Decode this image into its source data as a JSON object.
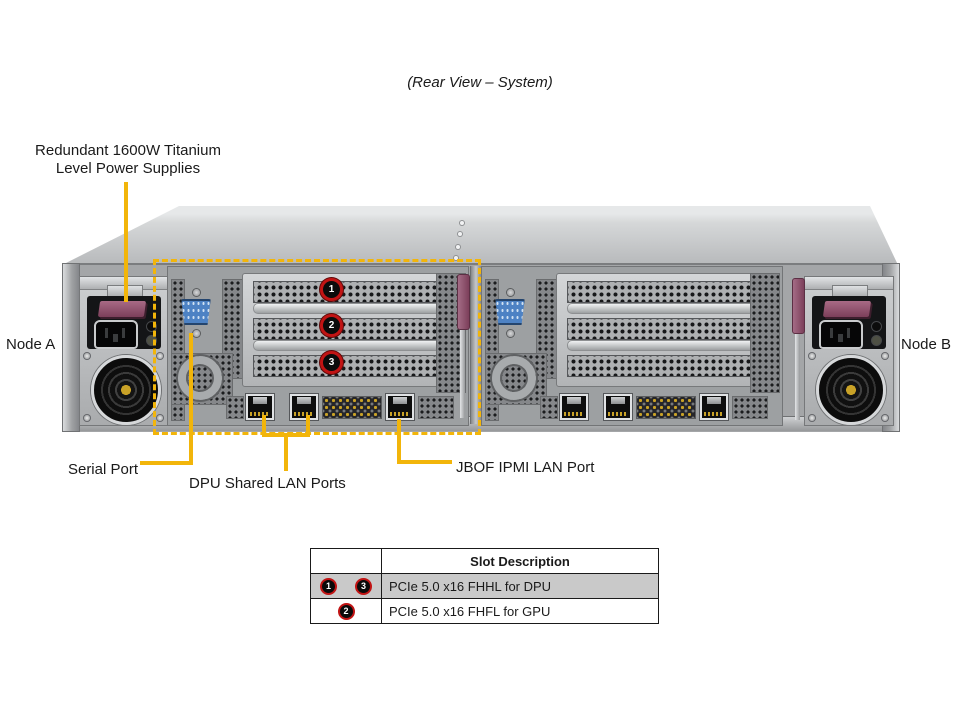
{
  "title": "(Rear View – System)",
  "labels": {
    "psu_line1": "Redundant 1600W Titanium",
    "psu_line2": "Level Power Supplies",
    "node_a": "Node A",
    "node_b": "Node B",
    "serial": "Serial Port",
    "dpu": "DPU Shared LAN Ports",
    "jbof": "JBOF IPMI LAN Port"
  },
  "chassis": {
    "slot_badges": [
      "1",
      "2",
      "3"
    ]
  },
  "table": {
    "header": "Slot Description",
    "rows": [
      {
        "slots": [
          "1",
          "3"
        ],
        "description": "PCIe 5.0 x16 FHHL for DPU"
      },
      {
        "slots": [
          "2"
        ],
        "description": "PCIe 5.0 x16 FHFL for GPU"
      }
    ]
  },
  "colors": {
    "callout_gold": "#F2B50A",
    "badge_ring_red": "#C11414",
    "table_row_highlight": "#C9C9C9",
    "serial_port_blue": "#4D82C4",
    "psu_latch_maroon": "#7C3F5A"
  }
}
